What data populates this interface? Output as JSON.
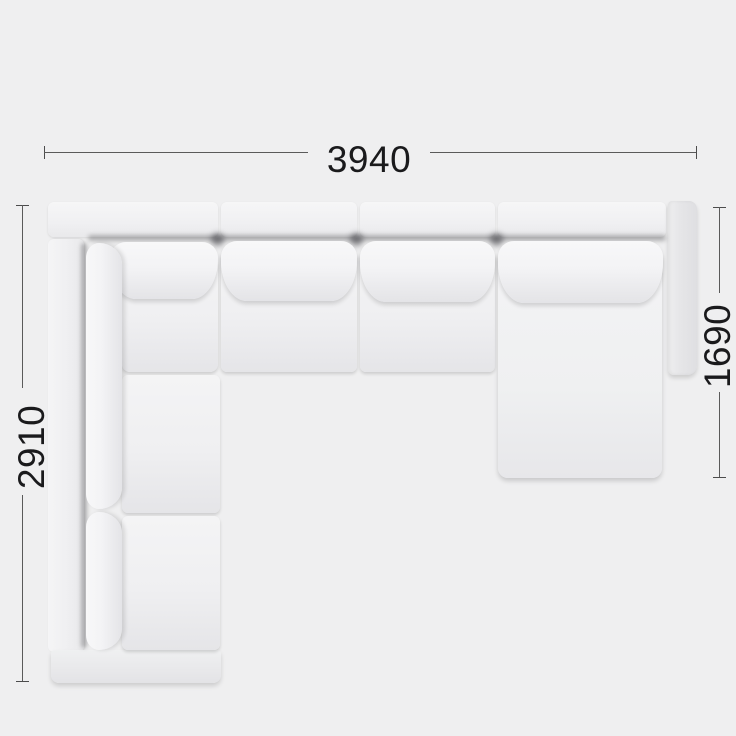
{
  "title": "Corner sectional sofa with chaise — top view dimension diagram",
  "dimensions": {
    "top": {
      "label": "3940"
    },
    "left": {
      "label": "2910"
    },
    "right": {
      "label": "1690"
    }
  },
  "sofa": {
    "view": "top",
    "shape": "L-shaped sectional with right chaise",
    "back_cushions_top_row": 4,
    "seats_top_row": 3,
    "seats_left_column": 3,
    "has_right_chaise": true,
    "has_right_armrest": true,
    "open_left_end": true
  },
  "colors": {
    "background": "#efeff0",
    "dimension_line": "#5a5a5a",
    "dimension_text": "#1a1a1c",
    "sofa_fabric": "#f2f2f4"
  }
}
